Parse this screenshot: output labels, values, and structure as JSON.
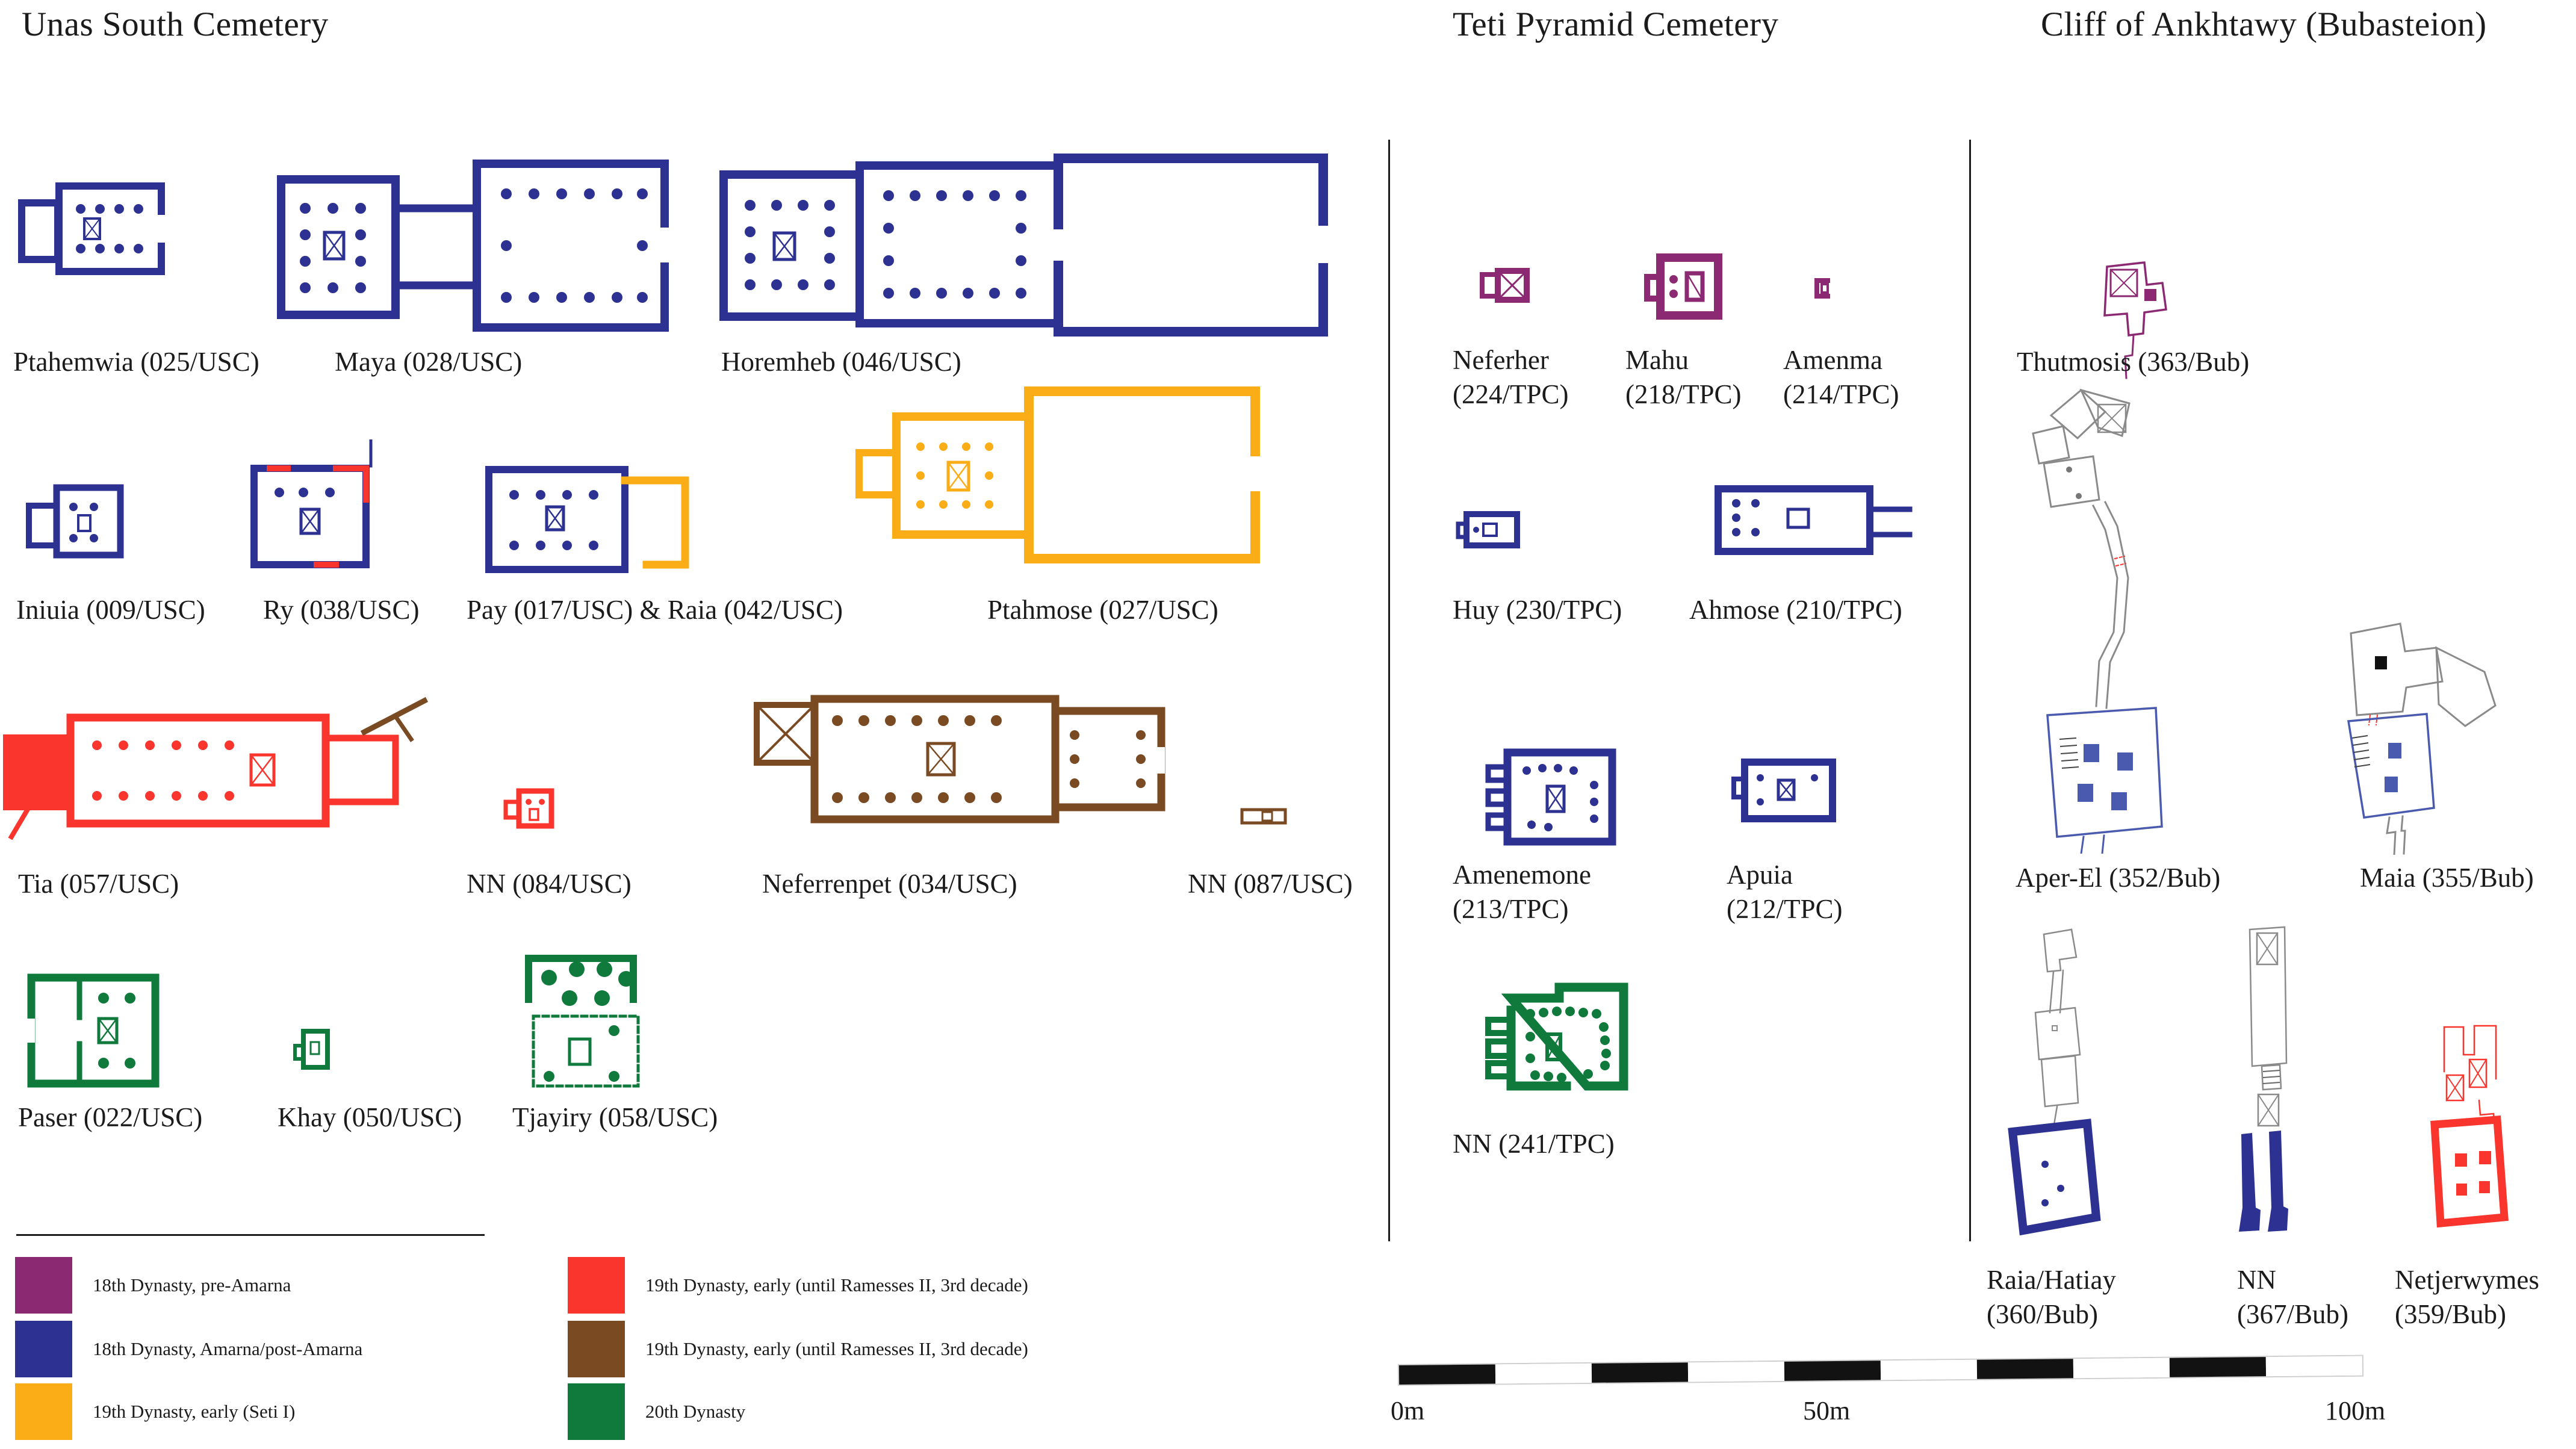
{
  "titles": {
    "usc": "Unas South Cemetery",
    "tpc": "Teti Pyramid Cemetery",
    "bub": "Cliff of Ankhtawy (Bubasteion)"
  },
  "palette": {
    "purple": "#8B2973",
    "blue": "#2D3292",
    "yellow": "#FBAD18",
    "red": "#F9352E",
    "brown": "#7A4A22",
    "green": "#107A3C",
    "gray": "#8A8A8A",
    "lightblue": "#4A5AAE",
    "text": "#1B1B1B"
  },
  "usc": {
    "tombs": [
      {
        "name": "Ptahemwia",
        "label1": "Ptahemwia (025/USC)",
        "label2": "",
        "color": "blue"
      },
      {
        "name": "Maya",
        "label1": "Maya (028/USC)",
        "label2": "",
        "color": "blue"
      },
      {
        "name": "Horemheb",
        "label1": "Horemheb (046/USC)",
        "label2": "",
        "color": "blue"
      },
      {
        "name": "Iniuia",
        "label1": "Iniuia (009/USC)",
        "label2": "",
        "color": "blue"
      },
      {
        "name": "Ry",
        "label1": "Ry (038/USC)",
        "label2": "",
        "color": "blue",
        "color2": "red"
      },
      {
        "name": "Pay & Raia",
        "label1": "Pay (017/USC) & Raia (042/USC)",
        "label2": "",
        "color": "blue",
        "color2": "yellow"
      },
      {
        "name": "Ptahmose",
        "label1": "Ptahmose (027/USC)",
        "label2": "",
        "color": "yellow"
      },
      {
        "name": "Tia",
        "label1": "Tia (057/USC)",
        "label2": "",
        "color": "red",
        "color2": "brown"
      },
      {
        "name": "NN 084",
        "label1": "NN (084/USC)",
        "label2": "",
        "color": "red"
      },
      {
        "name": "Neferrenpet",
        "label1": "Neferrenpet (034/USC)",
        "label2": "",
        "color": "brown"
      },
      {
        "name": "NN 087",
        "label1": "NN (087/USC)",
        "label2": "",
        "color": "brown"
      },
      {
        "name": "Paser",
        "label1": "Paser (022/USC)",
        "label2": "",
        "color": "green"
      },
      {
        "name": "Khay",
        "label1": "Khay (050/USC)",
        "label2": "",
        "color": "green"
      },
      {
        "name": "Tjayiry",
        "label1": "Tjayiry (058/USC)",
        "label2": "",
        "color": "green"
      }
    ]
  },
  "tpc": {
    "tombs": [
      {
        "name": "Neferher",
        "label1": "Neferher",
        "label2": "(224/TPC)",
        "color": "purple"
      },
      {
        "name": "Mahu",
        "label1": "Mahu",
        "label2": "(218/TPC)",
        "color": "purple"
      },
      {
        "name": "Amenma",
        "label1": "Amenma",
        "label2": "(214/TPC)",
        "color": "purple"
      },
      {
        "name": "Huy",
        "label1": "Huy (230/TPC)",
        "label2": "",
        "color": "blue"
      },
      {
        "name": "Ahmose",
        "label1": "Ahmose (210/TPC)",
        "label2": "",
        "color": "blue"
      },
      {
        "name": "Amenemone",
        "label1": "Amenemone",
        "label2": "(213/TPC)",
        "color": "blue"
      },
      {
        "name": "Apuia",
        "label1": "Apuia",
        "label2": "(212/TPC)",
        "color": "blue"
      },
      {
        "name": "NN 241",
        "label1": "NN (241/TPC)",
        "label2": "",
        "color": "green"
      }
    ]
  },
  "bub": {
    "tombs": [
      {
        "name": "Thutmosis",
        "label1": "Thutmosis (363/Bub)",
        "label2": "",
        "color": "purple"
      },
      {
        "name": "Aper-El",
        "label1": "Aper-El (352/Bub)",
        "label2": "",
        "color": "lightblue",
        "color2": "gray"
      },
      {
        "name": "Maia",
        "label1": "Maia (355/Bub)",
        "label2": "",
        "color": "lightblue",
        "color2": "gray"
      },
      {
        "name": "Raia/Hatiay",
        "label1": "Raia/Hatiay",
        "label2": "(360/Bub)",
        "color": "blue",
        "color2": "gray"
      },
      {
        "name": "NN 367",
        "label1": "NN",
        "label2": "(367/Bub)",
        "color": "blue",
        "color2": "gray"
      },
      {
        "name": "Netjerwymes",
        "label1": "Netjerwymes",
        "label2": "(359/Bub)",
        "color": "red"
      }
    ]
  },
  "legend": {
    "items": [
      {
        "color": "purple",
        "label": "18th Dynasty, pre-Amarna"
      },
      {
        "color": "blue",
        "label": "18th Dynasty, Amarna/post-Amarna"
      },
      {
        "color": "yellow",
        "label": "19th Dynasty, early (Seti I)"
      },
      {
        "color": "red",
        "label": "19th Dynasty, early (until Ramesses II, 3rd decade)"
      },
      {
        "color": "brown",
        "label": "19th Dynasty, early (until Ramesses II, 3rd decade)"
      },
      {
        "color": "green",
        "label": "20th Dynasty"
      }
    ]
  },
  "scalebar": {
    "start": "0m",
    "mid": "50m",
    "end": "100m"
  }
}
